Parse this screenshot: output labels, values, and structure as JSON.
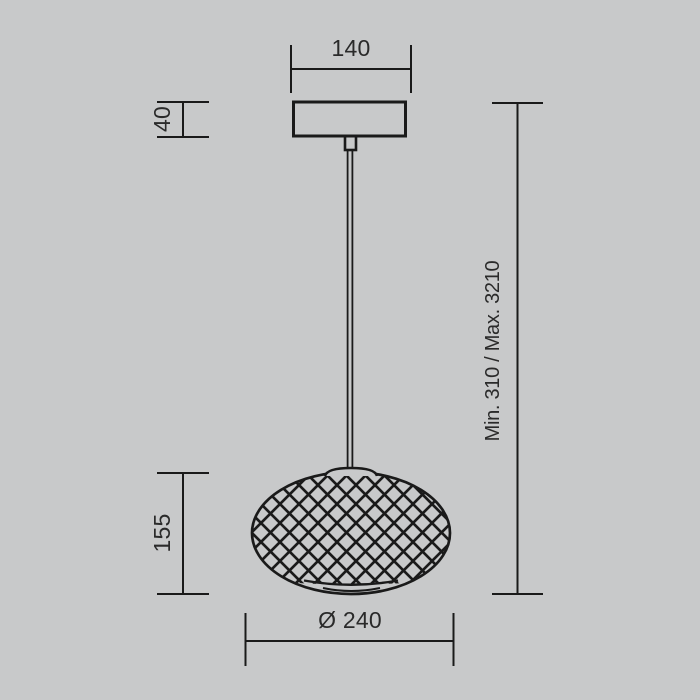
{
  "canvas": {
    "background": "#c8c9ca",
    "line_color": "#1a1a1a",
    "text_color": "#2a2a2a"
  },
  "drawing": {
    "title": "Pendant lamp technical dimension drawing",
    "labels": {
      "canopy_width": "140",
      "canopy_height": "40",
      "shade_height": "155",
      "shade_diameter": "Ø 240",
      "suspension_height": "Min. 310 / Max. 3210"
    }
  }
}
